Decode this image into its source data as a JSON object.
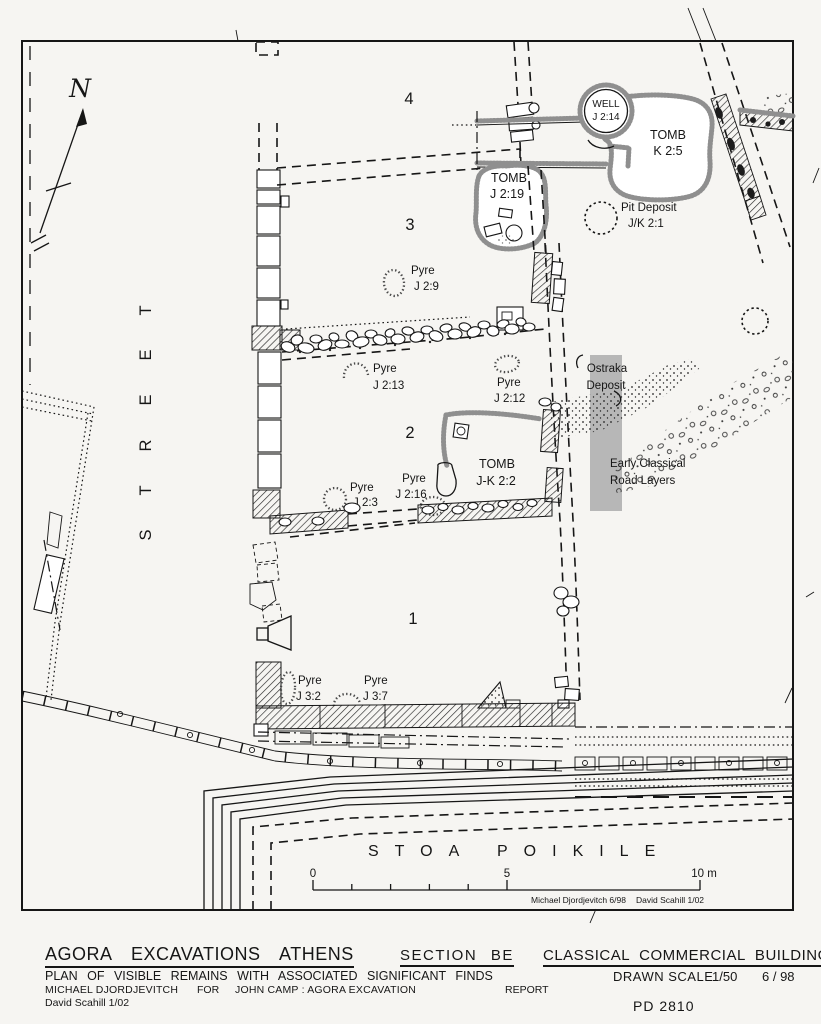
{
  "palette": {
    "paper": "#f6f5f2",
    "ink": "#161616",
    "fuzzy_gray": "#8f8f8f",
    "highlight_band": "#b7b7b7"
  },
  "compass": {
    "north_label": "N"
  },
  "street_label": "STREET",
  "room_labels": {
    "room1": "1",
    "room2": "2",
    "room3": "3",
    "room4": "4"
  },
  "features": {
    "well_j2_14": {
      "line1": "WELL",
      "line2": "J 2:14"
    },
    "tomb_k2_5": {
      "line1": "TOMB",
      "line2": "K 2:5"
    },
    "tomb_j2_19": {
      "line1": "TOMB",
      "line2": "J 2:19"
    },
    "pit_deposit_jk2_1": {
      "line1": "Pit Deposit",
      "line2": "J/K 2:1"
    },
    "pyre_j2_9": {
      "line1": "Pyre",
      "line2": "J 2:9"
    },
    "pyre_j2_13": {
      "line1": "Pyre",
      "line2": "J 2:13"
    },
    "pyre_j2_12": {
      "line1": "Pyre",
      "line2": "J 2:12"
    },
    "ostraka_deposit": {
      "line1": "Ostraka",
      "line2": "Deposit"
    },
    "early_classical_road": {
      "line1": "Early Classical",
      "line2": "Road Layers"
    },
    "tomb_jk2_2": {
      "line1": "TOMB",
      "line2": "J-K 2:2"
    },
    "pyre_j2_16": {
      "line1": "Pyre",
      "line2": "J 2:16"
    },
    "pyre_j2_3": {
      "line1": "Pyre",
      "line2": "J 2:3"
    },
    "pyre_j3_2": {
      "line1": "Pyre",
      "line2": "J 3:2"
    },
    "pyre_j3_7": {
      "line1": "Pyre",
      "line2": "J 3:7"
    }
  },
  "stoa": {
    "word1": "STOA",
    "word2": "POIKILE"
  },
  "scale_bar": {
    "zero": "0",
    "five": "5",
    "ten": "10 m"
  },
  "credits": {
    "drafter1": "Michael Djordjevitch  6/98",
    "drafter2": "David Scahill  1/02"
  },
  "title_block": {
    "project": "AGORA EXCAVATIONS ATHENS",
    "section": "SECTION BE",
    "building": "CLASSICAL COMMERCIAL BUILDING",
    "subtitle": "PLAN OF VISIBLE REMAINS WITH ASSOCIATED SIGNIFICANT FINDS",
    "scale_label": "DRAWN SCALE",
    "scale_value": "1/50",
    "date": "6 / 98",
    "author": "MICHAEL DJORDJEVITCH",
    "for_label": "FOR",
    "client": "JOHN CAMP :  AGORA EXCAVATION",
    "report_label": "REPORT",
    "author2": "David Scahill  1/02",
    "drawing_number": "PD 2810"
  }
}
